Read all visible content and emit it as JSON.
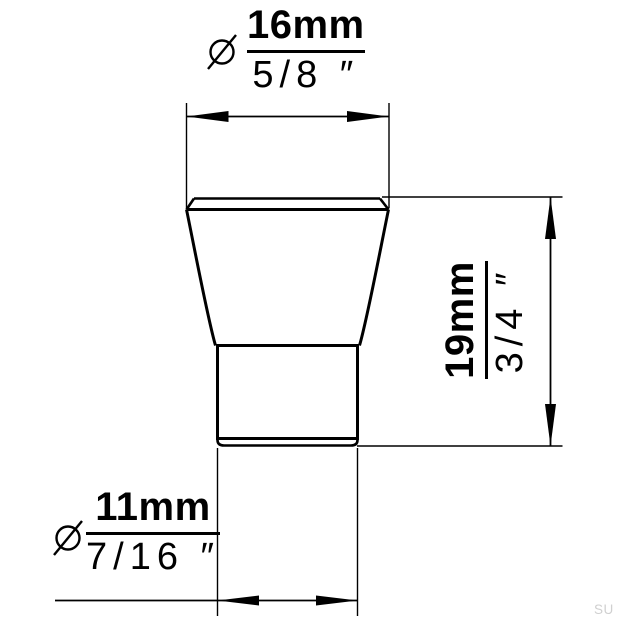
{
  "page": {
    "background": "#ffffff",
    "line_color": "#000000",
    "watermark": {
      "text": "SU",
      "color": "#d0d0d0"
    }
  },
  "drawing": {
    "dimensions": {
      "top_diameter": {
        "symbol": "⌀",
        "metric": "16mm",
        "imperial": "5/8 ″"
      },
      "height": {
        "metric": "19mm",
        "imperial": "3/4 ″"
      },
      "bottom_diameter": {
        "symbol": "⌀",
        "metric": "11mm",
        "imperial": "7/16 ″"
      }
    },
    "icons": {
      "top_diameter_symbol": "diameter-icon",
      "bottom_diameter_symbol": "diameter-icon"
    }
  }
}
